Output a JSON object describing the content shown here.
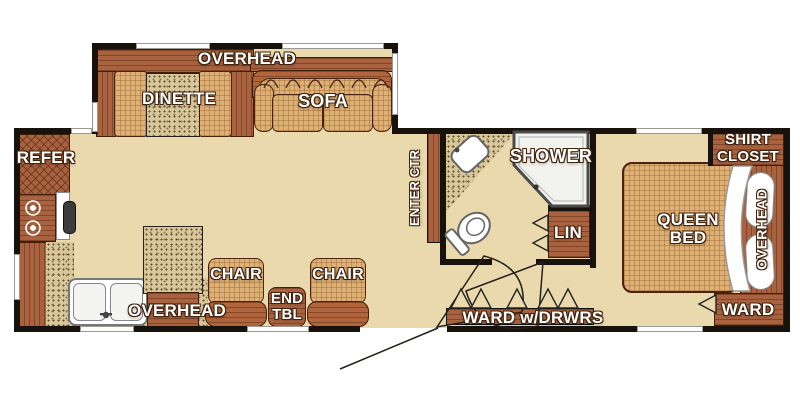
{
  "plan_type": "travel trailer floor plan",
  "colors": {
    "floor": "#ead9ad",
    "wall": "#17120c",
    "cabinet_wood": "#a9623f",
    "cushion": "#ddb077",
    "countertop_speckle": "#d8c79a",
    "fixture_white": "#ffffff",
    "label_text": "#ffffff",
    "label_outline": "#40230d"
  },
  "slide_out": {
    "overhead_label": "OVERHEAD",
    "dinette_label": "DINETTE",
    "sofa_label": "SOFA"
  },
  "kitchen": {
    "refer_label": "REFER",
    "overhead_label": "OVERHEAD"
  },
  "living": {
    "chair_left_label": "CHAIR",
    "chair_right_label": "CHAIR",
    "end_table_line1": "END",
    "end_table_line2": "TBL"
  },
  "bath": {
    "entertainment_center_label": "ENTER CTR",
    "shower_label": "SHOWER",
    "linen_label": "LIN"
  },
  "hall": {
    "wardrobe_drawers_label": "WARD w/DRWRS"
  },
  "bedroom": {
    "queen_line1": "QUEEN",
    "queen_line2": "BED",
    "shirt_closet_line1": "SHIRT",
    "shirt_closet_line2": "CLOSET",
    "overhead_label": "OVERHEAD",
    "ward_label": "WARD"
  }
}
